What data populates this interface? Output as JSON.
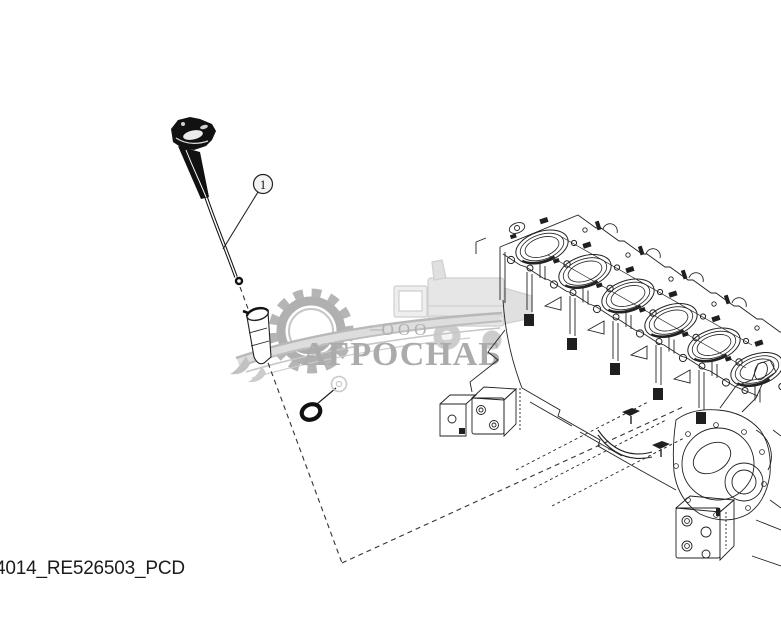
{
  "page": {
    "width": 781,
    "height": 641,
    "background": "#ffffff"
  },
  "caption": {
    "text": "4014_RE526503_PCD"
  },
  "callouts": [
    {
      "label": "1"
    }
  ],
  "watermark": {
    "org_type": "ООО",
    "name": "АГРОСНАБ",
    "text_color": "#aaaaaa",
    "gear_color": "#b5b5b5",
    "light_color": "#dedede",
    "elements": [
      "gear-icon",
      "wheat-swoosh-icon",
      "combine-harvester-icon"
    ]
  },
  "illustration": {
    "parts": [
      "engine-oil-dipstick",
      "dipstick-tube",
      "o-ring",
      "cylinder-block"
    ],
    "line_color": "#222222"
  }
}
